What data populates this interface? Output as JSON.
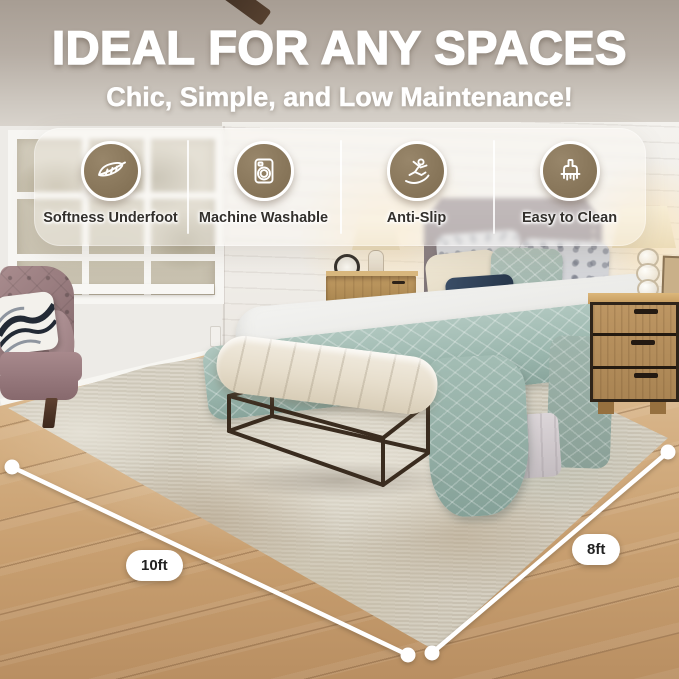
{
  "header": {
    "title": "IDEAL FOR ANY SPACES",
    "subtitle": "Chic, Simple, and Low Maintenance!"
  },
  "features": [
    {
      "label": "Softness Underfoot",
      "icon": "feather-icon"
    },
    {
      "label": "Machine Washable",
      "icon": "washing-machine-icon"
    },
    {
      "label": "Anti-Slip",
      "icon": "anti-slip-icon"
    },
    {
      "label": "Easy to Clean",
      "icon": "cleaning-brush-icon"
    }
  ],
  "rug_dimensions": {
    "left_label": "10ft",
    "right_label": "8ft"
  },
  "colors": {
    "feature_badge": "#87755a",
    "badge_border": "#ffffff",
    "headline_text": "#ffffff",
    "feature_label_text": "#33302c",
    "dimension_line": "#ffffff",
    "dimension_text": "#222222"
  }
}
